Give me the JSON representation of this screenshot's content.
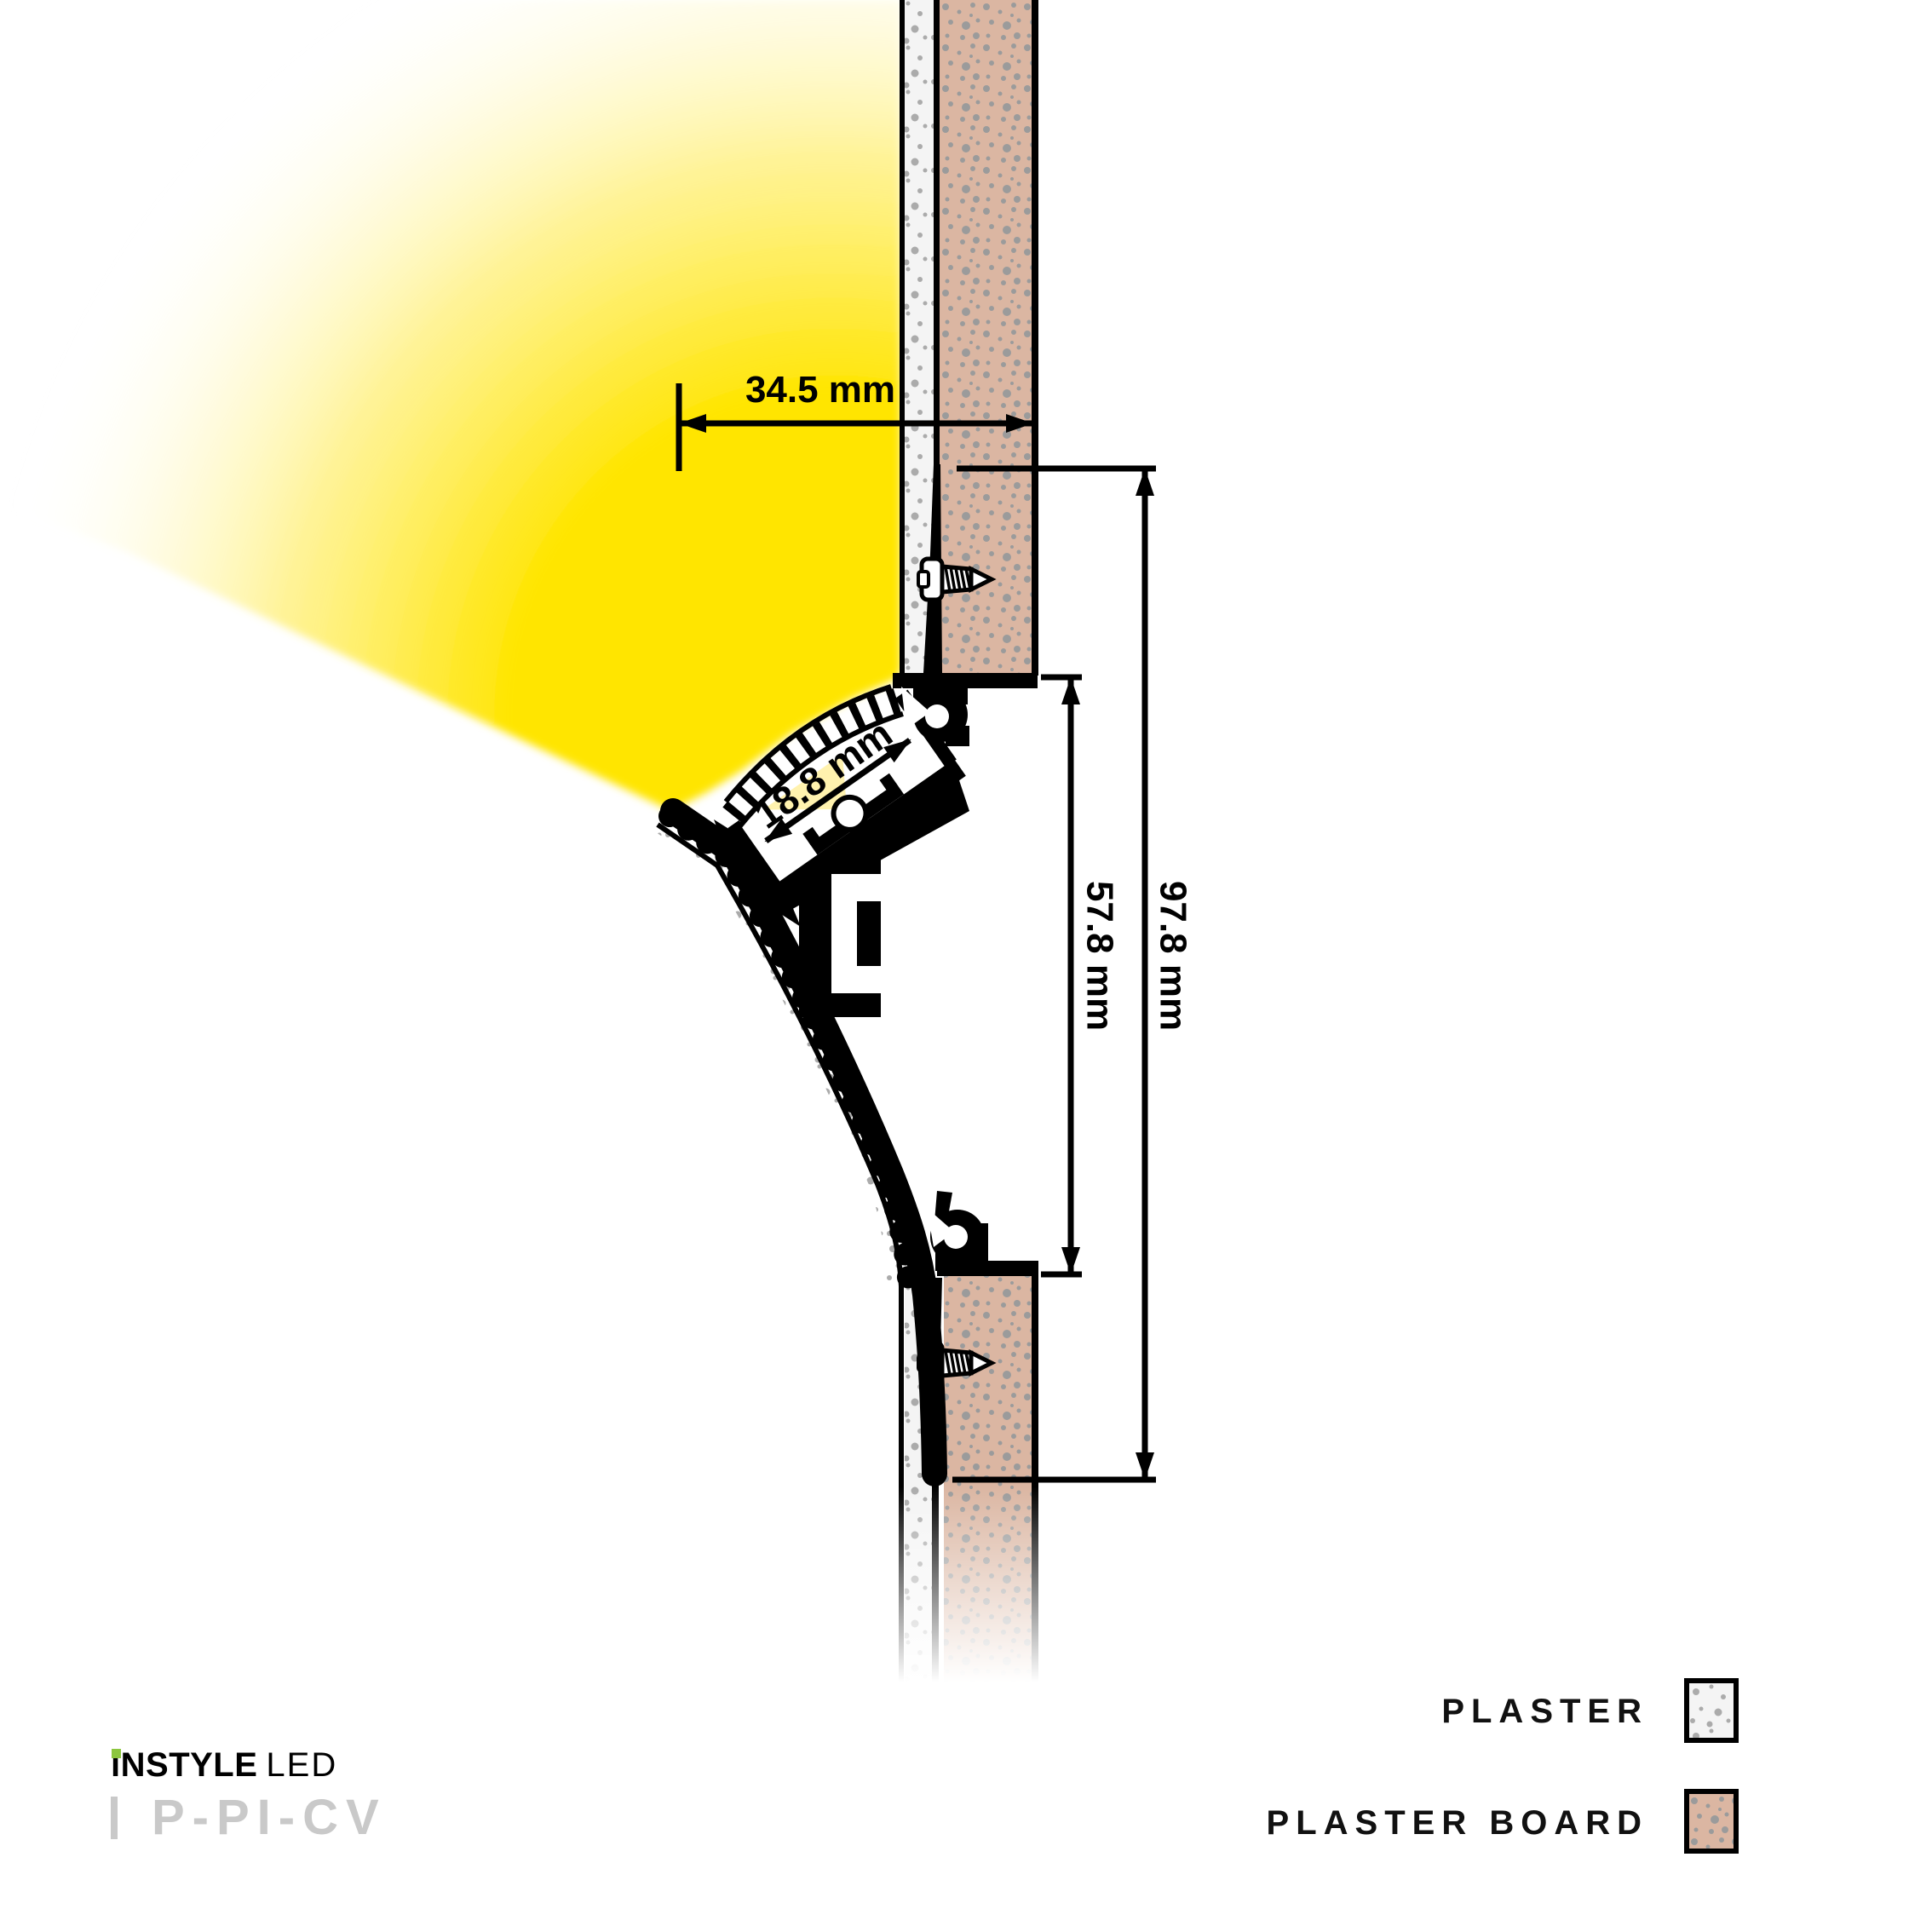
{
  "diagram": {
    "dim_width": "34.5 mm",
    "dim_channel": "18.8 mm",
    "dim_aperture": "57.8 mm",
    "dim_overall": "97.8 mm"
  },
  "legend": {
    "items": [
      {
        "label": "PLASTER",
        "swatch": "plaster"
      },
      {
        "label": "PLASTER BOARD",
        "swatch": "plaster-board"
      }
    ]
  },
  "branding": {
    "name": "iNSTYLE",
    "suffix": "LED",
    "product_code": "P-PI-CV"
  },
  "colors": {
    "glow": "#FFE502",
    "plaster": "#F4F4F4",
    "plaster_board": "#DBB6A2",
    "speckle_plaster": "#ABABAB",
    "speckle_board": "#9B9B9B",
    "ink": "#000000",
    "code_gray": "#C9C9C9",
    "brand_green": "#8CC63F"
  }
}
